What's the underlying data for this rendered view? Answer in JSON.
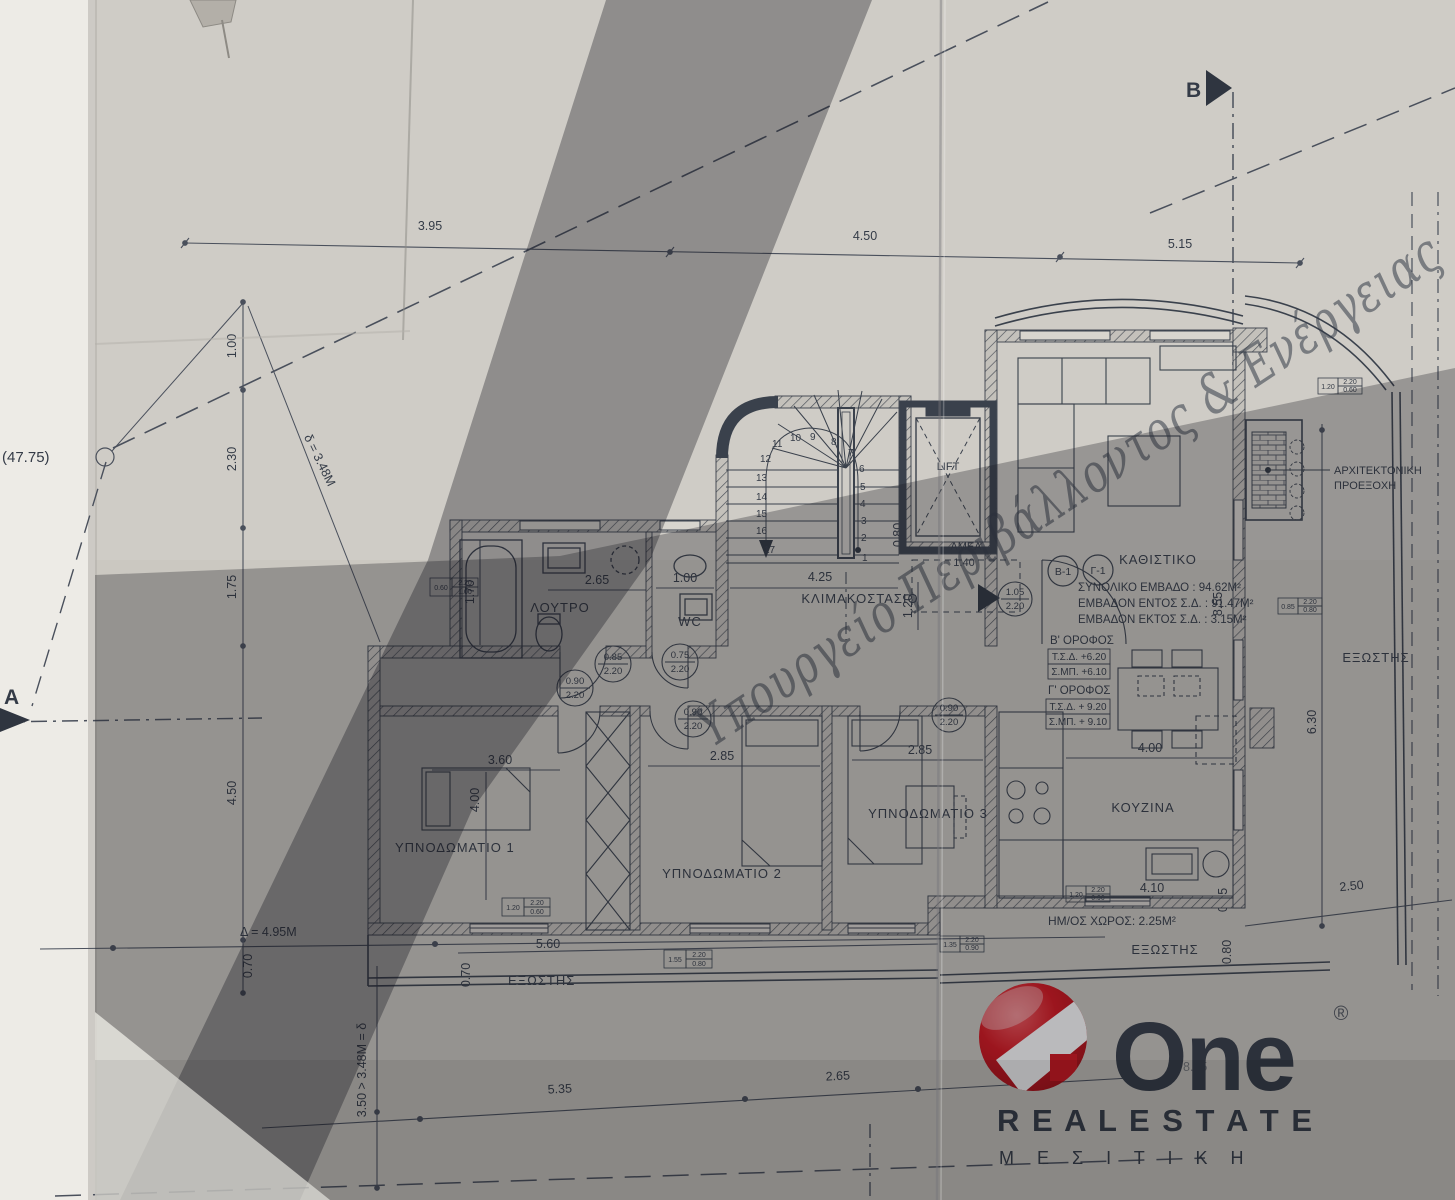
{
  "watermark": {
    "text": "Υπουργείο Περιβάλλοντος & Ενέργειας",
    "color": "#5b76bb"
  },
  "logo": {
    "one": "One",
    "reg": "®",
    "real_estate": "R E A L   E S T A T E",
    "mesitiki": "Μ Ε Σ Ι Τ Ι Κ Η",
    "red": "#d5141d",
    "dark": "#26262e"
  },
  "rooms": {
    "bath": "ΛΟΥΤΡΟ",
    "wc": "WC",
    "living": "ΚΑΘΙΣΤΙΚΟ",
    "kitchen": "ΚΟΥΖΙΝΑ",
    "bed1": "ΥΠΝΟΔΩΜΑΤΙΟ 1",
    "bed2": "ΥΠΝΟΔΩΜΑΤΙΟ 2",
    "bed3": "ΥΠΝΟΔΩΜΑΤΙΟ 3",
    "balcony_left": "ΕΞΩΣΤΗΣ",
    "balcony_right": "ΕΞΩΣΤΗΣ",
    "balcony_east": "ΕΞΩΣΤΗΣ",
    "semi_open": "ΗΜ/ΟΣ ΧΩΡΟΣ: 2.25M²"
  },
  "stair": {
    "label": "ΚΛΙΜΑΚΟΣΤΑΣΙΟ",
    "lift": "LIFT",
    "amea": "ΑΜΕΑ",
    "amea_clear": "1.40",
    "numbers": [
      "1",
      "2",
      "3",
      "4",
      "5",
      "6",
      "7",
      "8",
      "9",
      "10",
      "11",
      "12",
      "13",
      "14",
      "15",
      "16",
      "17"
    ]
  },
  "areas": {
    "tag_b": "B-1",
    "tag_c": "Γ-1",
    "total": "ΣΥΝΟΛΙΚΟ ΕΜΒΑΔΟ : 94.62M²",
    "inside": "ΕΜΒΑΔΟΝ ΕΝΤΟΣ Σ.Δ. : 91.47M²",
    "outside": "ΕΜΒΑΔΟΝ ΕΚΤΟΣ Σ.Δ. : 3.15M²",
    "floor_b_title": "Β' ΟΡΟΦΟΣ",
    "floor_b_tsd": "Τ.Σ.Δ.  +6.20",
    "floor_b_smp": "Σ.ΜΠ.  +6.10",
    "floor_c_title": "Γ' ΟΡΟΦΟΣ",
    "floor_c_tsd": "Τ.Σ.Δ. + 9.20",
    "floor_c_smp": "Σ.ΜΠ. + 9.10"
  },
  "annotation": {
    "line1": "ΑΡΧΙΤΕΚΤΟΝΙΚΗ",
    "line2": "ΠΡΟΕΞΟΧΗ"
  },
  "markers": {
    "b": "B",
    "a": "A",
    "elev": "(47.75)",
    "delta_line": "Δ = 4.95M",
    "delta_diag": "δ = 3.48M",
    "delta_vert": "3.50 > 3.48M = δ",
    "right_height": "8.55",
    "hidden_dim": "8.45"
  },
  "dims": {
    "top1": "3.95",
    "top2": "4.50",
    "top3": "5.15",
    "left1": "1.00",
    "left2": "2.30",
    "left3": "1.75",
    "left4": "4.50",
    "left5": "0.70",
    "bottom1": "5.35",
    "bottom2": "2.65",
    "bath_w": "2.65",
    "wc_w": "1.00",
    "bath_d": "1.70",
    "stair_w": "4.25",
    "stair_d": "1.20",
    "lift_off": "0.80",
    "bed1_w": "3.60",
    "bed1_d": "4.00",
    "bed2_w": "2.85",
    "bed3_w": "2.85",
    "dining_w": "4.00",
    "kitch_w": "4.10",
    "kitch_off": "0.55",
    "kitch_rail": "0.80",
    "balc_left_w": "5.60",
    "balc_left_d": "0.70",
    "east_len": "6.30",
    "east_bottom": "2.50"
  },
  "doors": {
    "bath": {
      "w": "0.90",
      "h": "2.20"
    },
    "hall": {
      "w": "0.85",
      "h": "2.20"
    },
    "wc": {
      "w": "0.75",
      "h": "2.20"
    },
    "bed2": {
      "w": "0.90",
      "h": "2.20"
    },
    "bed3": {
      "w": "0.90",
      "h": "2.20"
    },
    "living": {
      "w": "1.05",
      "h": "2.20"
    }
  },
  "windows": {
    "bath": [
      "0.60",
      "2.20",
      "1.00"
    ],
    "topright": [
      "1.20",
      "2.20",
      "0.60"
    ],
    "east": [
      "0.85",
      "2.20",
      "0.80"
    ],
    "bed1": [
      "1.20",
      "2.20",
      "0.60"
    ],
    "bed2": [
      "1.55",
      "2.20",
      "0.80"
    ],
    "balc_r": [
      "1.35",
      "2.20",
      "0.90"
    ],
    "kitchen": [
      "1.20",
      "2.20",
      "0.90"
    ]
  }
}
